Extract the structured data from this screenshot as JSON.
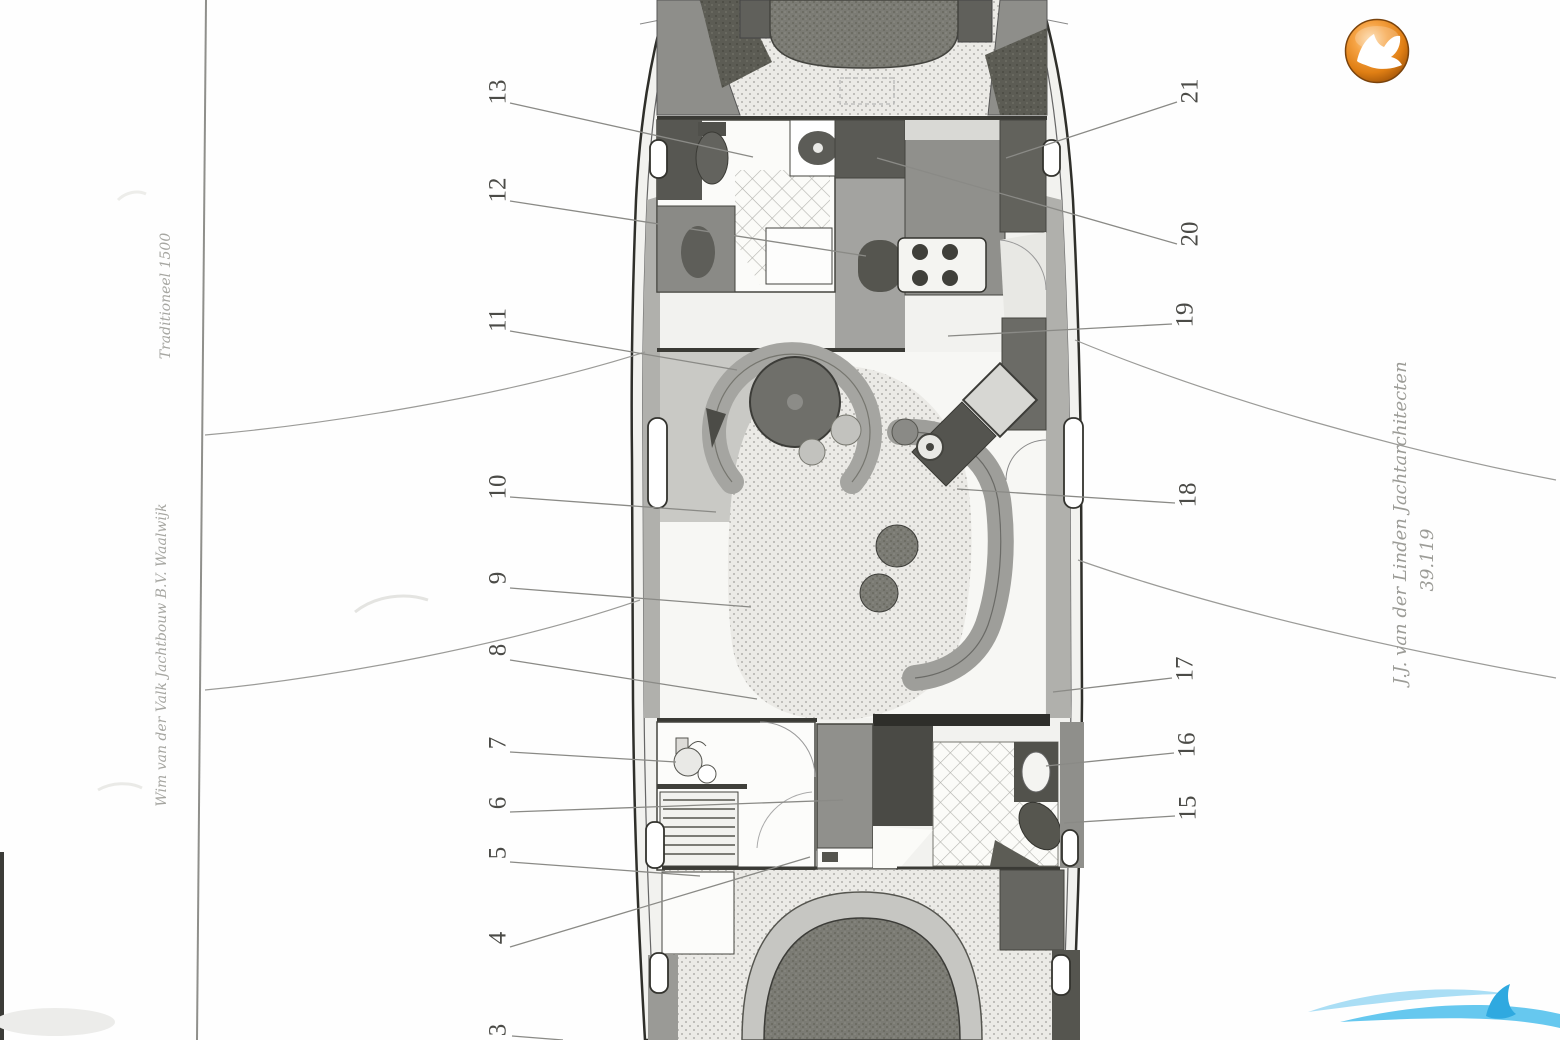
{
  "texts": {
    "left_margin_upper": "Traditioneel 1500",
    "left_margin_lower": "Wim van der Valk Jachtbouw B.V. Waalwijk",
    "right_margin_firm": "J.J. van der Linden Jachtarchitecten",
    "right_margin_number": "39.119"
  },
  "branding": {
    "logo_icon": "orange-falcon-sphere-logo",
    "logo_color": "#e8821e",
    "watermark_icon": "blue-wave-swoosh-watermark",
    "watermark_color": "#56c3ee"
  },
  "plan": {
    "callouts": [
      {
        "label": "13",
        "num": [
          498,
          92
        ],
        "line": [
          510,
          103,
          753,
          157
        ]
      },
      {
        "label": "12",
        "num": [
          498,
          190
        ],
        "line": [
          510,
          201,
          866,
          256
        ]
      },
      {
        "label": "11",
        "num": [
          498,
          320
        ],
        "line": [
          510,
          331,
          737,
          370
        ]
      },
      {
        "label": "10",
        "num": [
          498,
          487
        ],
        "line": [
          510,
          497,
          716,
          512
        ]
      },
      {
        "label": "9",
        "num": [
          498,
          578
        ],
        "line": [
          510,
          588,
          751,
          607
        ]
      },
      {
        "label": "8",
        "num": [
          498,
          650
        ],
        "line": [
          510,
          660,
          757,
          699
        ]
      },
      {
        "label": "7",
        "num": [
          498,
          743
        ],
        "line": [
          510,
          752,
          676,
          762
        ]
      },
      {
        "label": "6",
        "num": [
          498,
          803
        ],
        "line": [
          510,
          812,
          843,
          800
        ]
      },
      {
        "label": "5",
        "num": [
          498,
          853
        ],
        "line": [
          510,
          862,
          700,
          876
        ]
      },
      {
        "label": "4",
        "num": [
          498,
          938
        ],
        "line": [
          510,
          947,
          810,
          857
        ]
      },
      {
        "label": "3",
        "num": [
          498,
          1030
        ],
        "line": [
          512,
          1036,
          563,
          1040
        ]
      },
      {
        "label": "21",
        "num": [
          1190,
          91
        ],
        "line": [
          1177,
          102,
          1006,
          158
        ]
      },
      {
        "label": "20",
        "num": [
          1190,
          234
        ],
        "line": [
          1177,
          244,
          877,
          158
        ]
      },
      {
        "label": "19",
        "num": [
          1185,
          315
        ],
        "line": [
          1172,
          324,
          948,
          336
        ]
      },
      {
        "label": "18",
        "num": [
          1188,
          495
        ],
        "line": [
          1175,
          503,
          957,
          489
        ]
      },
      {
        "label": "17",
        "num": [
          1185,
          669
        ],
        "line": [
          1172,
          678,
          1053,
          692
        ]
      },
      {
        "label": "16",
        "num": [
          1187,
          745
        ],
        "line": [
          1174,
          753,
          1046,
          766
        ]
      },
      {
        "label": "15",
        "num": [
          1188,
          808
        ],
        "line": [
          1175,
          816,
          1064,
          823
        ]
      }
    ]
  }
}
